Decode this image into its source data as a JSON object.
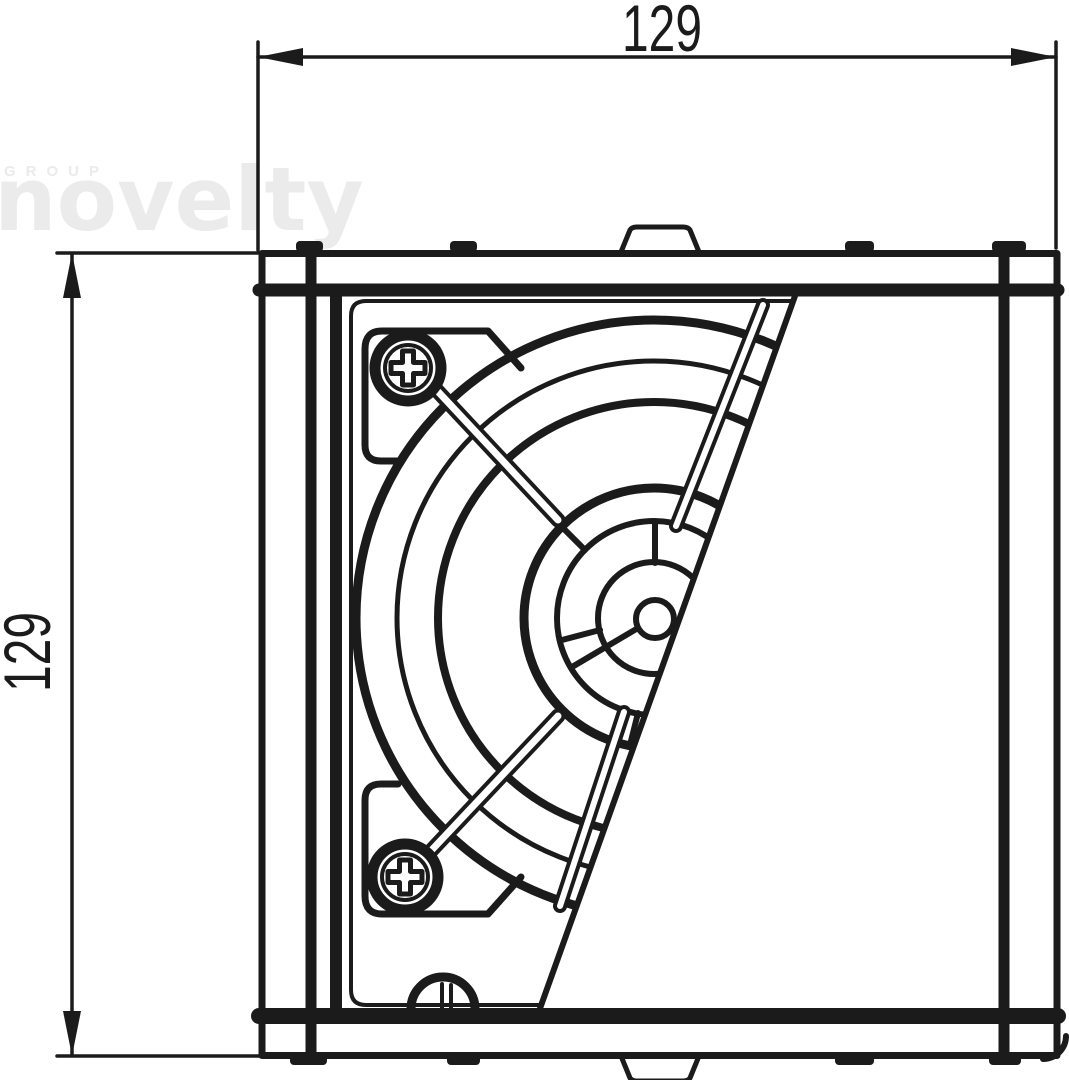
{
  "page": {
    "background_color": "#ffffff"
  },
  "watermark": {
    "line1": "GROUP",
    "line2": "novelty",
    "color": "#ebebeb"
  },
  "dimensions": {
    "width": {
      "value": "129"
    },
    "height": {
      "value": "129"
    }
  },
  "drawing": {
    "line_color": "#1b1b1b",
    "components": [
      "outer-housing-frame",
      "top-rail",
      "bottom-rail",
      "left-side-rail",
      "right-side-rail",
      "inner-panel",
      "fan-grille-rings",
      "fan-hub",
      "grille-wires",
      "phillips-screw-top-left",
      "phillips-screw-bottom-left",
      "screw-mounting-tabs",
      "cable-gland",
      "diagonal-panel-edge",
      "mounting-feet-tabs"
    ]
  }
}
